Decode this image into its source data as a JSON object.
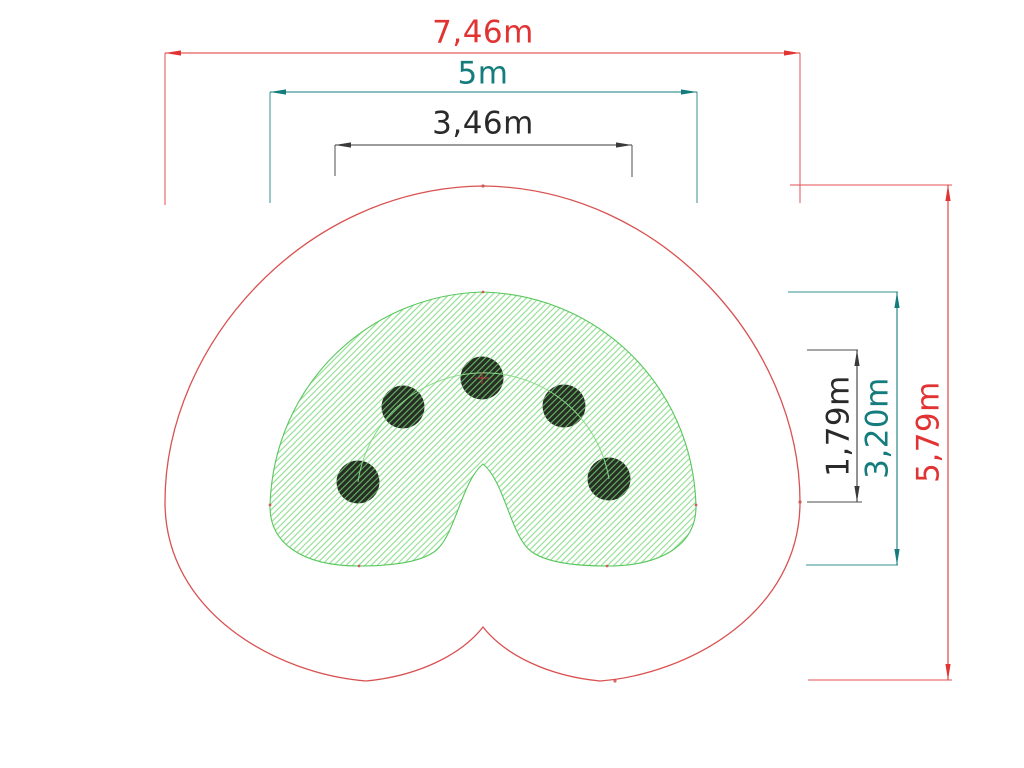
{
  "drawing": {
    "kind": "playground-equipment-plan-view",
    "post_count": 5
  },
  "dimensions": {
    "top": [
      {
        "id": "overall-width",
        "label": "7,46m",
        "color": "#e23333"
      },
      {
        "id": "impact-width",
        "label": "5m",
        "color": "#147c7c"
      },
      {
        "id": "posts-width",
        "label": "3,46m",
        "color": "#2a2a2a"
      }
    ],
    "right": [
      {
        "id": "posts-height",
        "label": "1,79m",
        "color": "#2a2a2a"
      },
      {
        "id": "impact-height",
        "label": "3,20m",
        "color": "#147c7c"
      },
      {
        "id": "overall-height",
        "label": "5,79m",
        "color": "#e23333"
      }
    ]
  },
  "colors": {
    "dimension_red": "#e23333",
    "dimension_teal": "#147c7c",
    "dimension_black": "#2a2a2a",
    "safety_outline_red": "#d95252",
    "zone_outline_green": "#58c75c",
    "hatch_green": "#76d676",
    "guide_arc_green": "#8adc8a",
    "post_fill": "#272f25",
    "background": "#ffffff"
  }
}
